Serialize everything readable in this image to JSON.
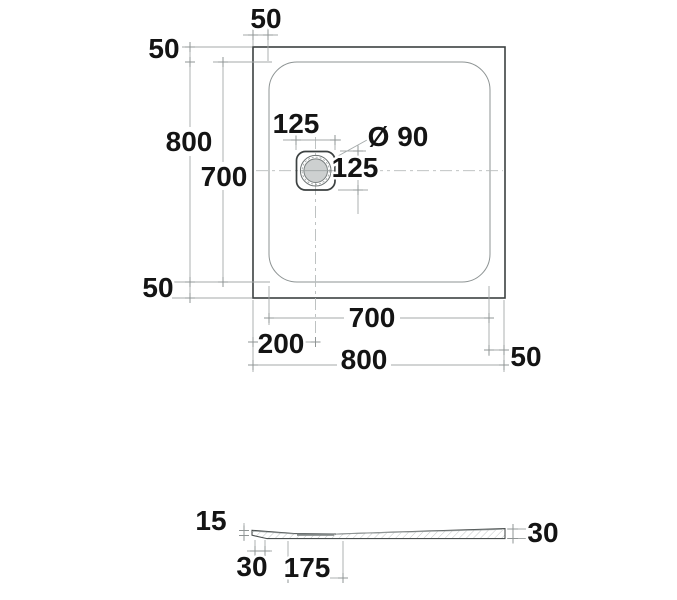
{
  "colors": {
    "background": "#ffffff",
    "outline": "#3c4141",
    "dimension_line": "#a4a9a9",
    "dimension_text": "#141414",
    "drain_fill": "#cdd0d0"
  },
  "top_view": {
    "dimensions": {
      "corner_offset_top": "50",
      "corner_offset_left": "50",
      "overall_height": "800",
      "inner_height": "700",
      "corner_offset_bottom": "50",
      "drain_plate_width": "125",
      "drain_diameter": "Ø 90",
      "drain_plate_height": "125",
      "inner_width": "700",
      "drain_center_from_left": "200",
      "overall_width": "800",
      "corner_offset_right": "50"
    }
  },
  "side_view": {
    "dimensions": {
      "edge_thickness": "15",
      "foot_width": "30",
      "drain_offset": "175",
      "overall_thickness": "30"
    }
  }
}
